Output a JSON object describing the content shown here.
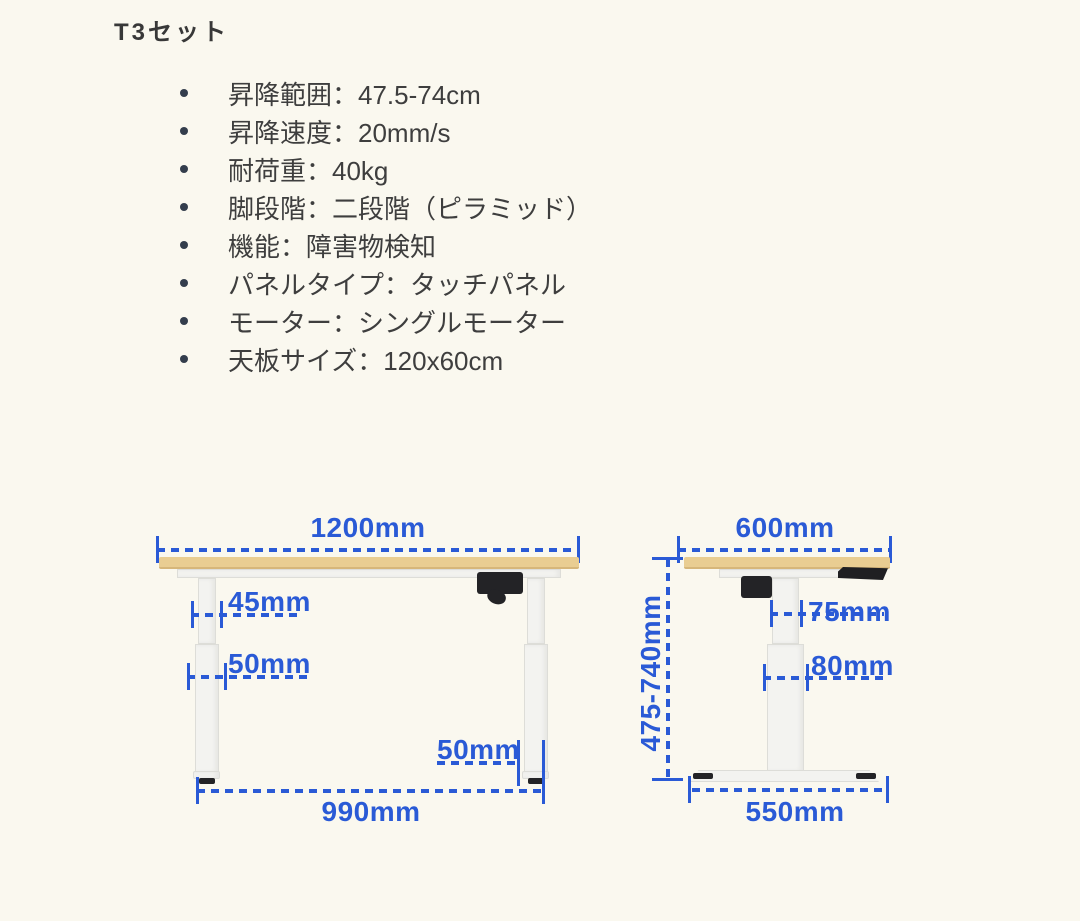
{
  "title": "T3セット",
  "specs": {
    "items": [
      "昇降範囲：47.5-74cm",
      "昇降速度：20mm/s",
      "耐荷重：40kg",
      "脚段階：二段階（ピラミッド）",
      "機能：障害物検知",
      "パネルタイプ：タッチパネル",
      "モーター：シングルモーター",
      "天板サイズ：120x60cm"
    ]
  },
  "diagrams": {
    "front_view": {
      "top_width": "1200mm",
      "upper_leg_width": "45mm",
      "lower_leg_width": "50mm",
      "foot_width": "50mm",
      "leg_span": "990mm"
    },
    "side_view": {
      "top_depth": "600mm",
      "height_range": "475-740mm",
      "upper_column_depth": "75mm",
      "lower_column_depth": "80mm",
      "foot_depth": "550mm"
    }
  },
  "colors": {
    "dimension_blue": "#2a5ad6",
    "tabletop_wood": "#e9cd92",
    "desk_frame_white": "#f3f3f0",
    "accent_black": "#232326",
    "background": "#faf8ef",
    "text": "#3e3e3e"
  }
}
